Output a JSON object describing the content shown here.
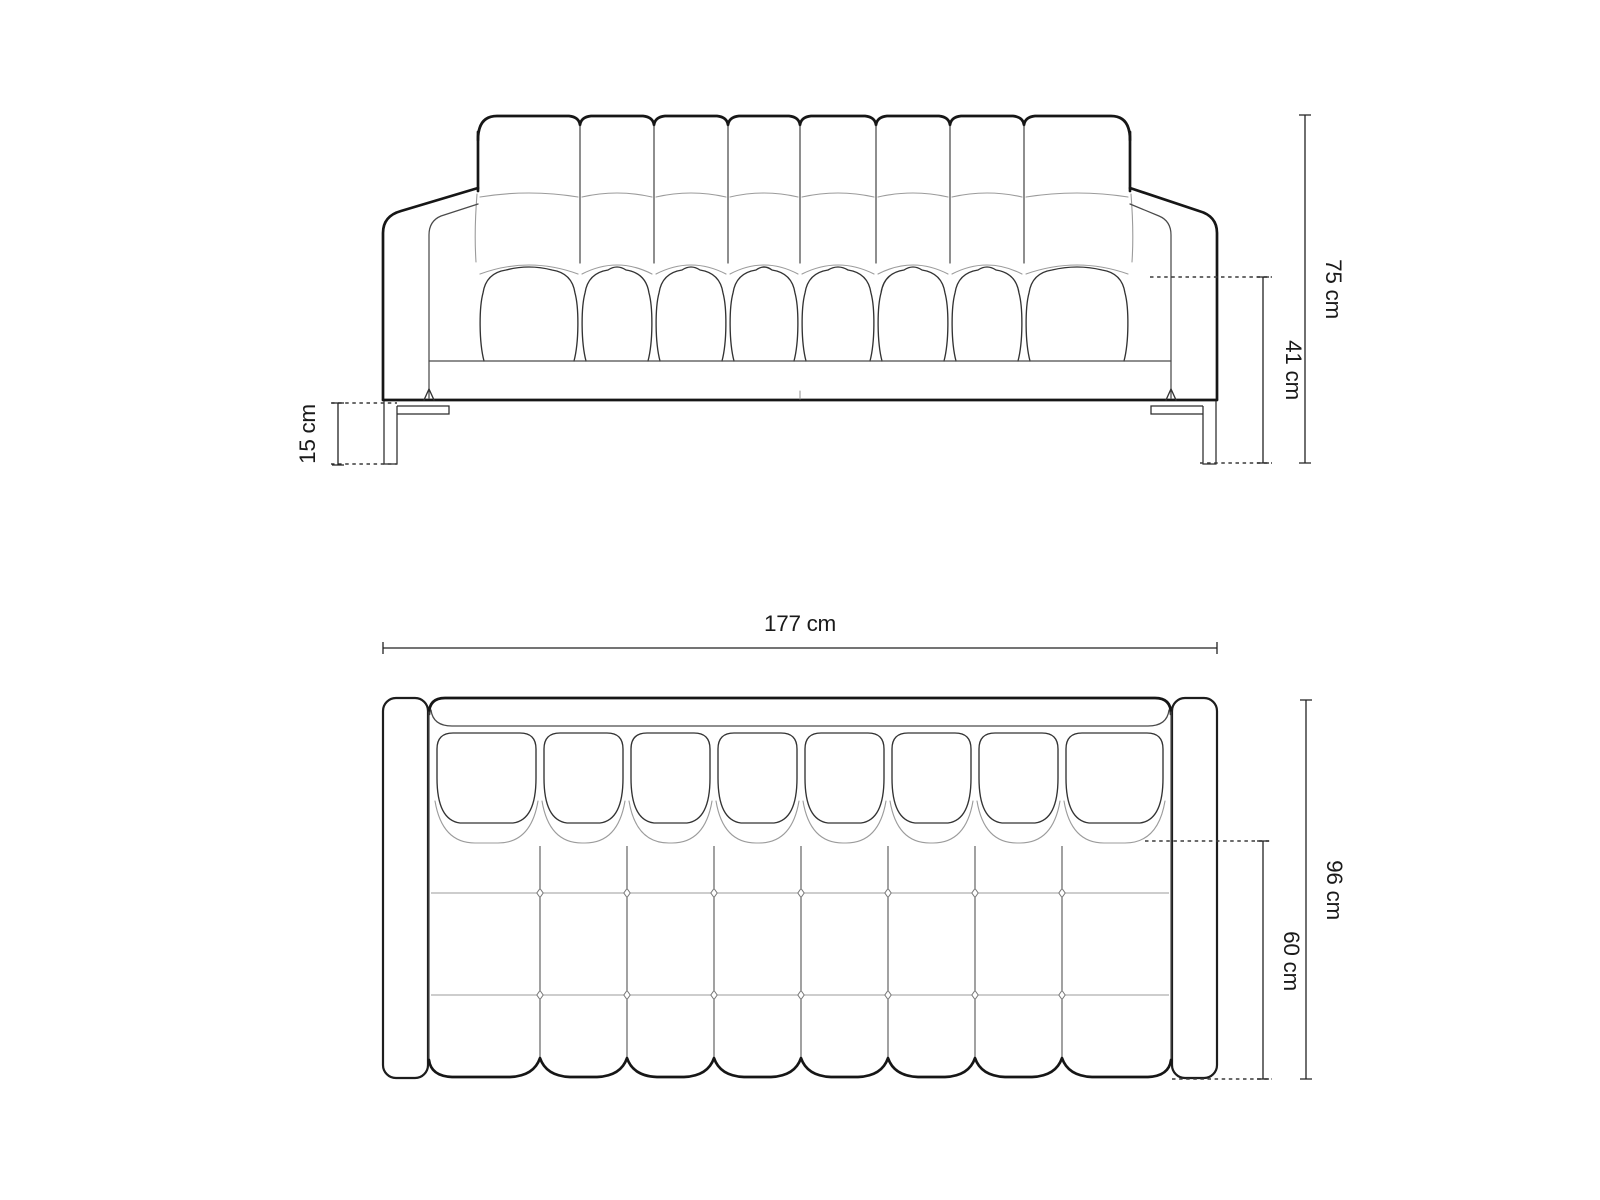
{
  "figure": {
    "kind": "sofa-dimension-diagram",
    "colors": {
      "background": "#ffffff",
      "outline": "#161616",
      "seam": "#4a4a4a",
      "light_seam": "#9b9b9b",
      "dimension": "#222222"
    },
    "views": {
      "front": {
        "total_height_label": "75 cm",
        "seat_height_label": "41 cm",
        "leg_height_label": "15 cm"
      },
      "top": {
        "width_label": "177 cm",
        "depth_label": "96 cm",
        "seat_depth_label": "60 cm"
      }
    }
  }
}
